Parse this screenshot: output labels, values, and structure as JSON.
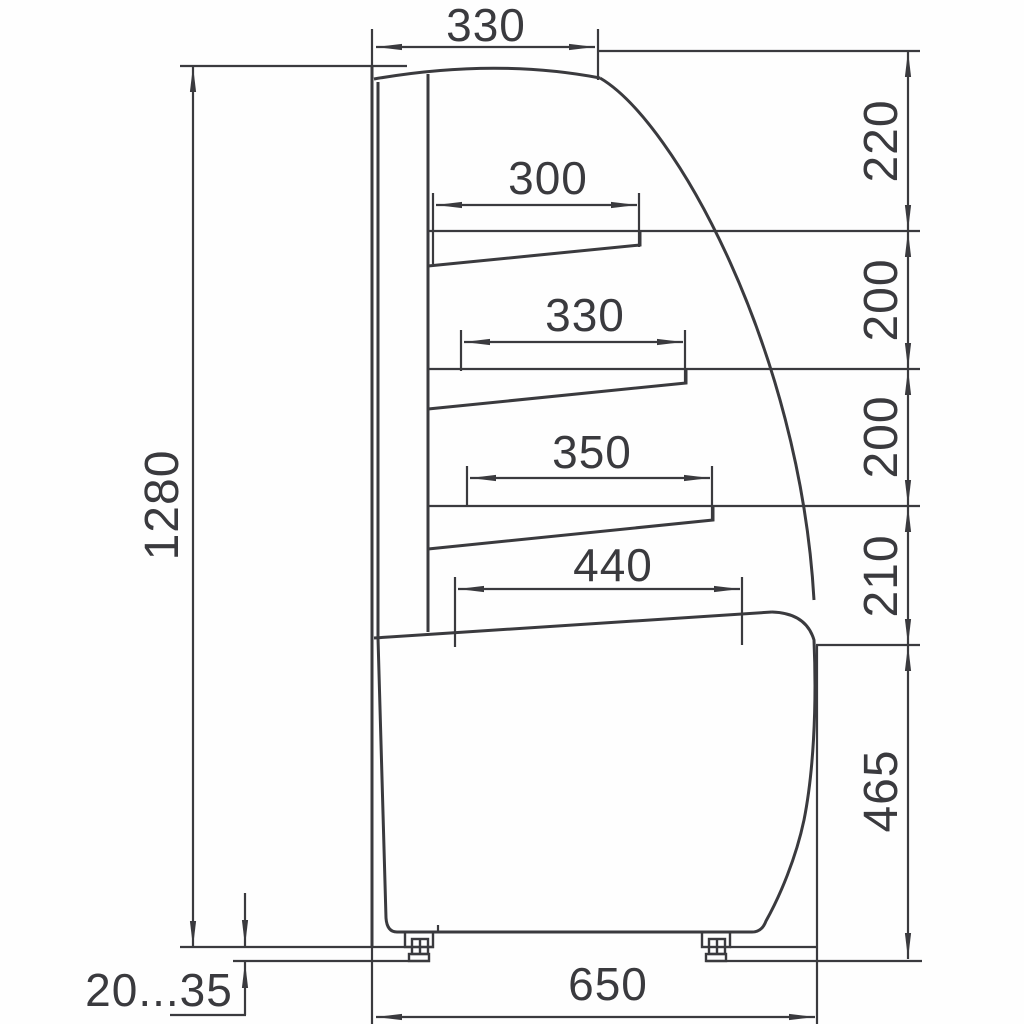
{
  "drawing": {
    "dimensions": {
      "top_depth": "330",
      "shelf1_depth": "300",
      "shelf2_depth": "330",
      "shelf3_depth": "350",
      "deck_depth": "440",
      "overall_height": "1280",
      "gap_top": "220",
      "gap_second": "200",
      "gap_third": "200",
      "gap_fourth": "210",
      "base_height": "465",
      "base_depth": "650",
      "leg_adjust_range": "20...35"
    },
    "colors": {
      "line": "#3a3a3e",
      "background": "#ffffff"
    }
  }
}
